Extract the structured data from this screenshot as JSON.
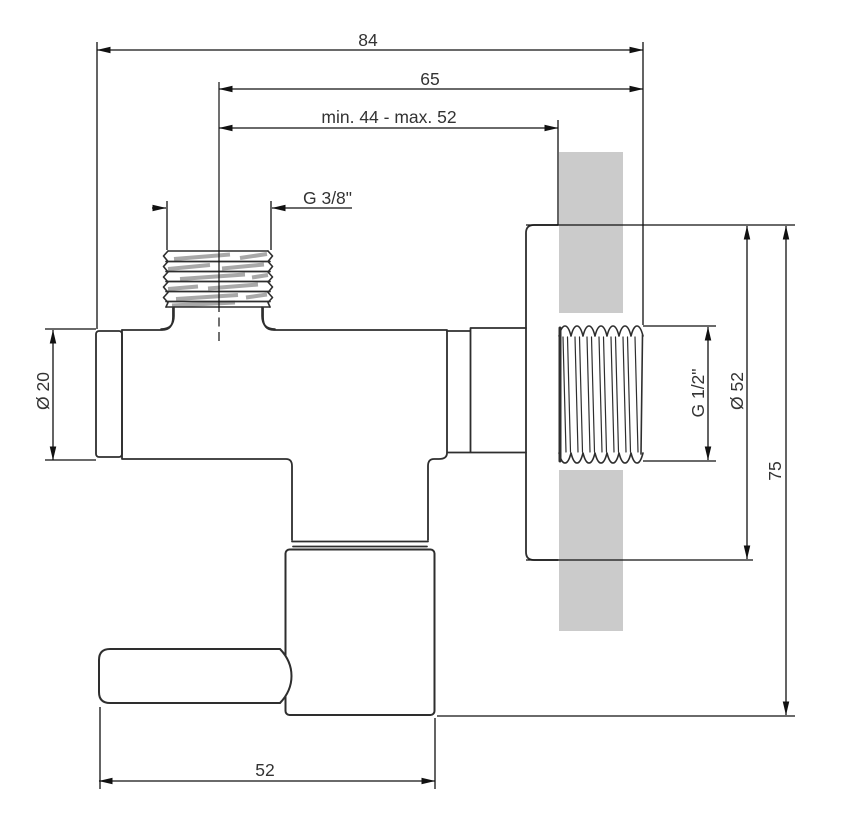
{
  "page": {
    "colors": {
      "line": "#2e2e2e",
      "dimension": "#111111",
      "text": "#333333",
      "wall_fill": "#cbcbcb",
      "thread_stripe": "#a9a9a9",
      "background": "#ffffff"
    },
    "labels": {
      "total_length": "84",
      "axis_length": "65",
      "wall_range": "min. 44 - max. 52",
      "top_thread": "G 3/8\"",
      "outlet_diameter": "Ø 20",
      "inlet_thread": "G 1/2\"",
      "flange_diameter": "Ø 52",
      "overall_height": "75",
      "handle_length": "52"
    }
  }
}
